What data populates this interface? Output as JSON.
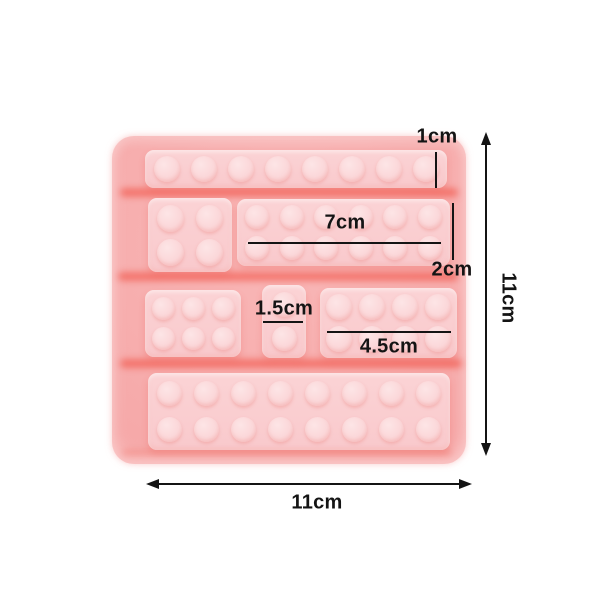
{
  "colors": {
    "background": "#ffffff",
    "mold_base": "#f6a9a9",
    "brick_face": "#fbd0d2",
    "stud_face": "#fbd9da",
    "groove_shadow": "#f0463a",
    "annotation": "#141414"
  },
  "mold": {
    "bricks": [
      {
        "name": "brick-1x8-top",
        "rows": 1,
        "cols": 8,
        "x": 33,
        "y": 14,
        "w": 302,
        "h": 38,
        "stud": 26
      },
      {
        "name": "brick-2x2",
        "rows": 2,
        "cols": 2,
        "x": 36,
        "y": 62,
        "w": 84,
        "h": 74,
        "stud": 27
      },
      {
        "name": "brick-2x6",
        "rows": 2,
        "cols": 6,
        "x": 125,
        "y": 63,
        "w": 213,
        "h": 67,
        "stud": 24
      },
      {
        "name": "brick-2x3",
        "rows": 2,
        "cols": 3,
        "x": 33,
        "y": 154,
        "w": 96,
        "h": 67,
        "stud": 23
      },
      {
        "name": "brick-1x2-small",
        "rows": 2,
        "cols": 1,
        "x": 150,
        "y": 149,
        "w": 44,
        "h": 73,
        "stud": 25
      },
      {
        "name": "brick-2x4",
        "rows": 2,
        "cols": 4,
        "x": 208,
        "y": 152,
        "w": 137,
        "h": 70,
        "stud": 26
      },
      {
        "name": "brick-2x8-bottom",
        "rows": 2,
        "cols": 8,
        "x": 36,
        "y": 237,
        "w": 302,
        "h": 77,
        "stud": 25
      }
    ]
  },
  "dimensions": {
    "stud_height": "1cm",
    "long_brick_width": "7cm",
    "brick_height": "2cm",
    "small_brick_width": "1.5cm",
    "medium_brick_width": "4.5cm",
    "mold_height": "11cm",
    "mold_width": "11cm"
  }
}
